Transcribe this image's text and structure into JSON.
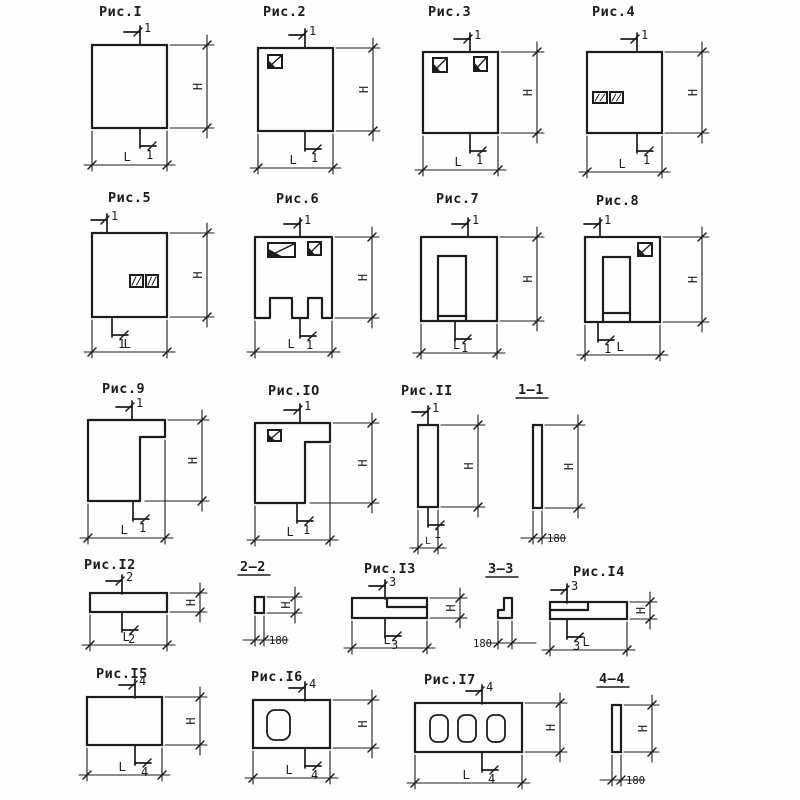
{
  "page": {
    "background": "#fefefe",
    "ink": "#1c1c1c",
    "description": "Sheet of typical concrete wall-panel shape diagrams with dimension lines"
  },
  "labels": {
    "height": "H",
    "length": "L"
  },
  "figures": [
    {
      "id": "fig1",
      "title": "Рис.I",
      "cut": "1",
      "shape": "solid-square-panel"
    },
    {
      "id": "fig2",
      "title": "Рис.2",
      "cut": "1",
      "shape": "square-panel-window-top-left"
    },
    {
      "id": "fig3",
      "title": "Рис.3",
      "cut": "1",
      "shape": "square-panel-two-windows-top"
    },
    {
      "id": "fig4",
      "title": "Рис.4",
      "cut": "1",
      "shape": "square-panel-two-openings-middle-left"
    },
    {
      "id": "fig5",
      "title": "Рис.5",
      "cut": "1",
      "shape": "square-panel-two-openings-center"
    },
    {
      "id": "fig6",
      "title": "Рис.6",
      "cut": "1",
      "shape": "panel-windows-and-bottom-notches"
    },
    {
      "id": "fig7",
      "title": "Рис.7",
      "cut": "1",
      "shape": "panel-with-door-opening"
    },
    {
      "id": "fig8",
      "title": "Рис.8",
      "cut": "1",
      "shape": "panel-with-door-and-window"
    },
    {
      "id": "fig9",
      "title": "Рис.9",
      "cut": "1",
      "shape": "gamma-shaped-panel"
    },
    {
      "id": "fig10",
      "title": "Рис.IO",
      "cut": "1",
      "shape": "gamma-shaped-panel-with-window"
    },
    {
      "id": "fig11",
      "title": "Рис.II",
      "cut": "1",
      "shape": "narrow-vertical-panel"
    },
    {
      "id": "fig12",
      "title": "Рис.I2",
      "cut": "2",
      "shape": "horizontal-strip-panel"
    },
    {
      "id": "fig13",
      "title": "Рис.I3",
      "cut": "3",
      "shape": "strip-panel-rebate-right"
    },
    {
      "id": "fig14",
      "title": "Рис.I4",
      "cut": "3",
      "shape": "strip-panel-rebate-left"
    },
    {
      "id": "fig15",
      "title": "Рис.I5",
      "cut": "4",
      "shape": "solid-rectangle-panel"
    },
    {
      "id": "fig16",
      "title": "Рис.I6",
      "cut": "4",
      "shape": "rectangle-panel-one-void"
    },
    {
      "id": "fig17",
      "title": "Рис.I7",
      "cut": "4",
      "shape": "rectangle-panel-three-voids"
    }
  ],
  "sections": [
    {
      "id": "sec1",
      "title": "1—1",
      "has_height": true,
      "thickness": "180"
    },
    {
      "id": "sec2",
      "title": "2—2",
      "has_height": true,
      "thickness": "180"
    },
    {
      "id": "sec3",
      "title": "3—3",
      "has_height": false,
      "thickness": "180"
    },
    {
      "id": "sec4",
      "title": "4—4",
      "has_height": true,
      "thickness": "180"
    }
  ]
}
